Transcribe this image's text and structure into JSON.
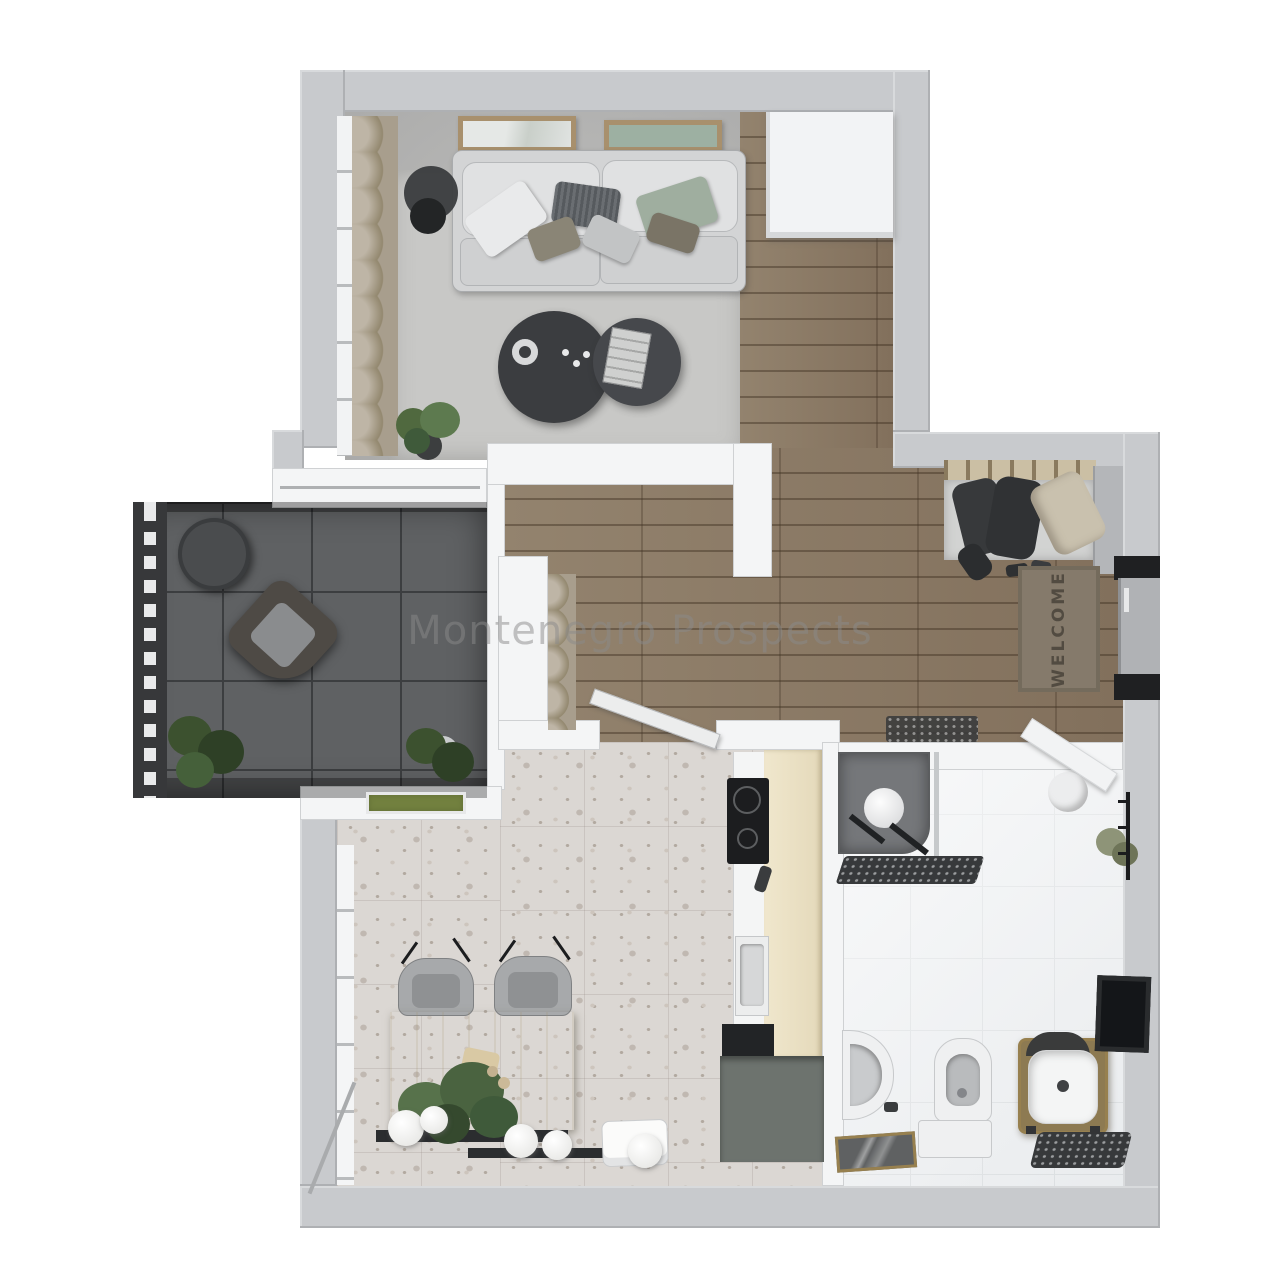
{
  "watermark": {
    "text": "Montenegro Prospects",
    "color": "#8a8a8a"
  },
  "entry": {
    "welcome_mat_text": "WELCOME",
    "welcome_mat_color": "#857a6b",
    "front_door_color": "#b0b2b5"
  },
  "palette": {
    "exterior_wall": "#c8cacd",
    "interior_wall": "#f1f2f4",
    "wood_floor": "#8c7b66",
    "living_concrete": "#b4b4b3",
    "living_rug": "#c8c8c6",
    "balcony_tile": "#5f6163",
    "kitchen_terrazzo": "#dbd7d3",
    "bathroom_tile": "#eef0f2",
    "counter_wood": "#ece2c6",
    "brass_accent": "#97804f",
    "plant_green": "#4e6b42",
    "coffee_table_dark": "#3b3d40"
  },
  "rooms": [
    {
      "name": "living-room",
      "floor": "concrete-with-rug"
    },
    {
      "name": "hallway",
      "floor": "wood-plank"
    },
    {
      "name": "kitchen-dining",
      "floor": "terrazzo"
    },
    {
      "name": "bathroom",
      "floor": "white-tile"
    },
    {
      "name": "balcony",
      "floor": "dark-tile"
    },
    {
      "name": "entry",
      "floor": "wood-plank"
    }
  ],
  "furniture": [
    "sofa",
    "throw-pillows",
    "wall-art-frames",
    "floor-lamp",
    "coffee-tables",
    "decor-bowl",
    "magazine",
    "curtains",
    "potted-plants",
    "balcony-table",
    "balcony-armchair",
    "dining-table",
    "dining-chairs",
    "pendant-spheres",
    "kitchen-counter",
    "induction-hob",
    "kitchen-sink",
    "tall-cabinet",
    "shower",
    "shower-mat",
    "towels",
    "toilet",
    "bidet",
    "vanity-basin",
    "bath-mat",
    "wall-mirror",
    "wardrobe-rack",
    "coat-rug",
    "shoes",
    "front-door",
    "welcome-mat",
    "white-wardrobe"
  ]
}
